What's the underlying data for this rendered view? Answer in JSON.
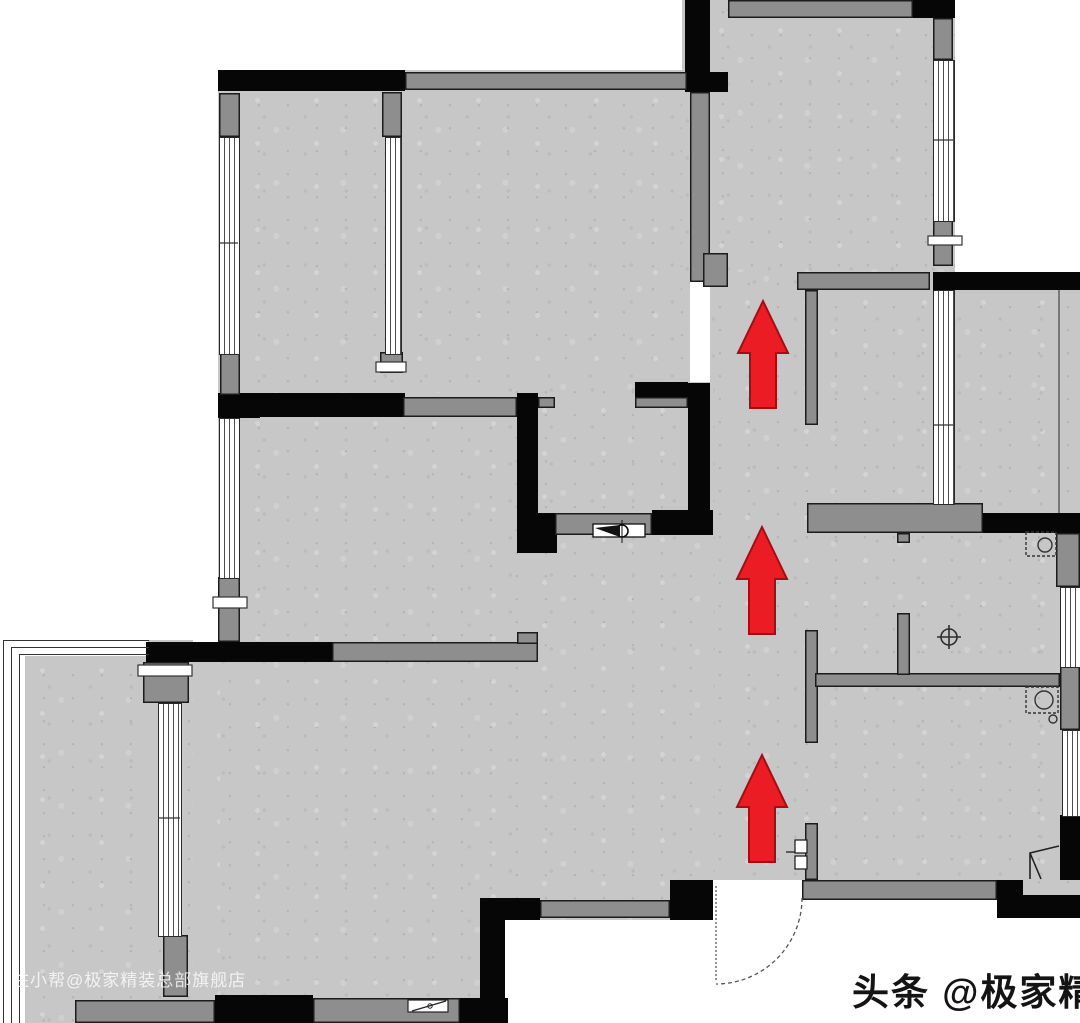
{
  "plan": {
    "title": "apartment-floor-plan",
    "watermark": "住小帮@极家精装总部旗舰店",
    "brand": "头条 @极家精装",
    "arrows": {
      "count": 3,
      "direction": "up",
      "color": "#ec1c24"
    },
    "colors": {
      "floor": "#c7c7c7",
      "wall_black": "#060606",
      "wall_gray": "#8e8e8e",
      "window_line": "#4d4d4d",
      "arrow_red": "#ec1c24"
    }
  }
}
